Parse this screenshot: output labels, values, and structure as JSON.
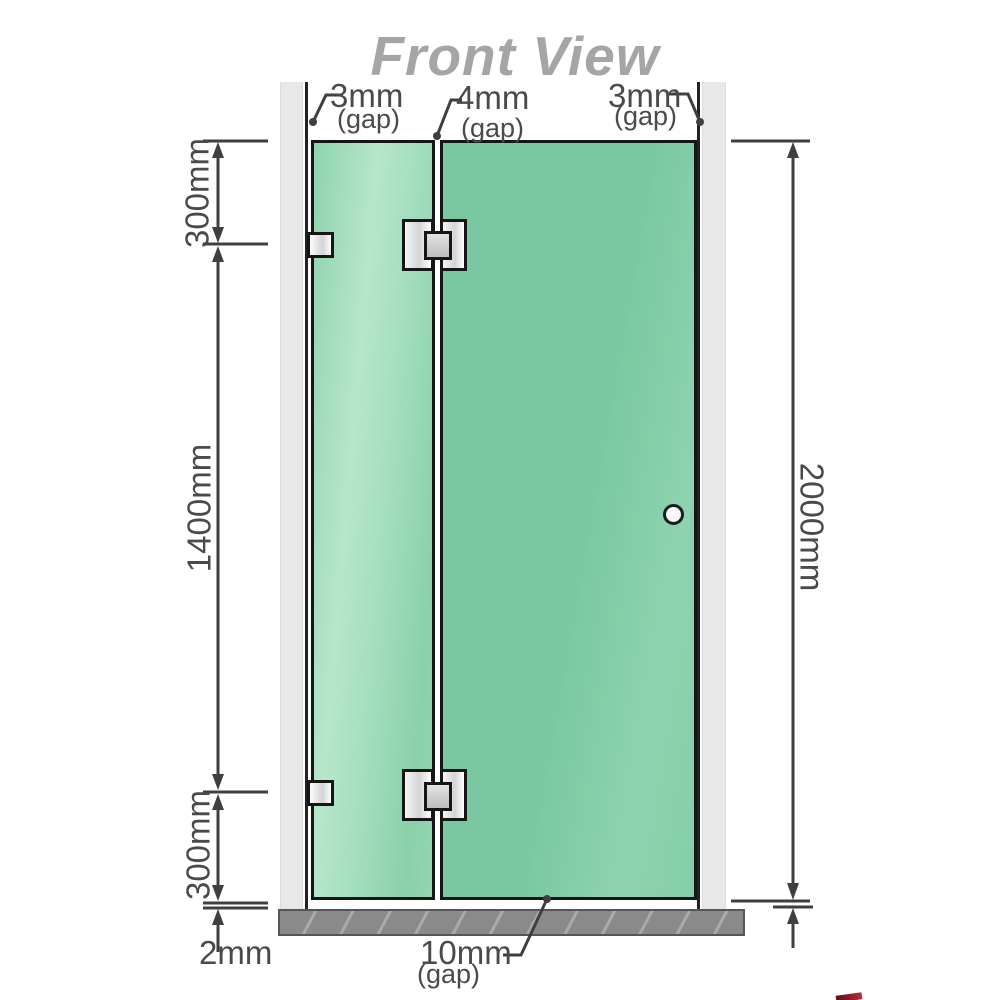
{
  "title": "Front View",
  "gaps": {
    "top_left": {
      "value": "3mm",
      "suffix": "(gap)"
    },
    "top_middle": {
      "value": "4mm",
      "suffix": "(gap)"
    },
    "top_right": {
      "value": "3mm",
      "suffix": "(gap)"
    },
    "bottom_door": {
      "value": "10mm",
      "suffix": "(gap)"
    },
    "bottom_floor": {
      "value": "2mm"
    }
  },
  "heights": {
    "top_section": "300mm",
    "middle_section": "1400mm",
    "bottom_section": "300mm",
    "overall": "2000mm"
  },
  "colors": {
    "glass_green": "#7cc9a2",
    "glass_green_light": "#b7e6ca",
    "glass_border": "#161616",
    "wall_gray": "#e8e8e8",
    "wall_edge": "#222222",
    "floor_gray": "#8a8a8a",
    "dim_line": "#3f3f3f",
    "label_text": "#4a4a4a",
    "title_text": "#a5a5a5",
    "hardware_light": "#f5f5f5",
    "hardware_mid": "#d4d4d4",
    "watermark_red": "#8e1b20"
  }
}
